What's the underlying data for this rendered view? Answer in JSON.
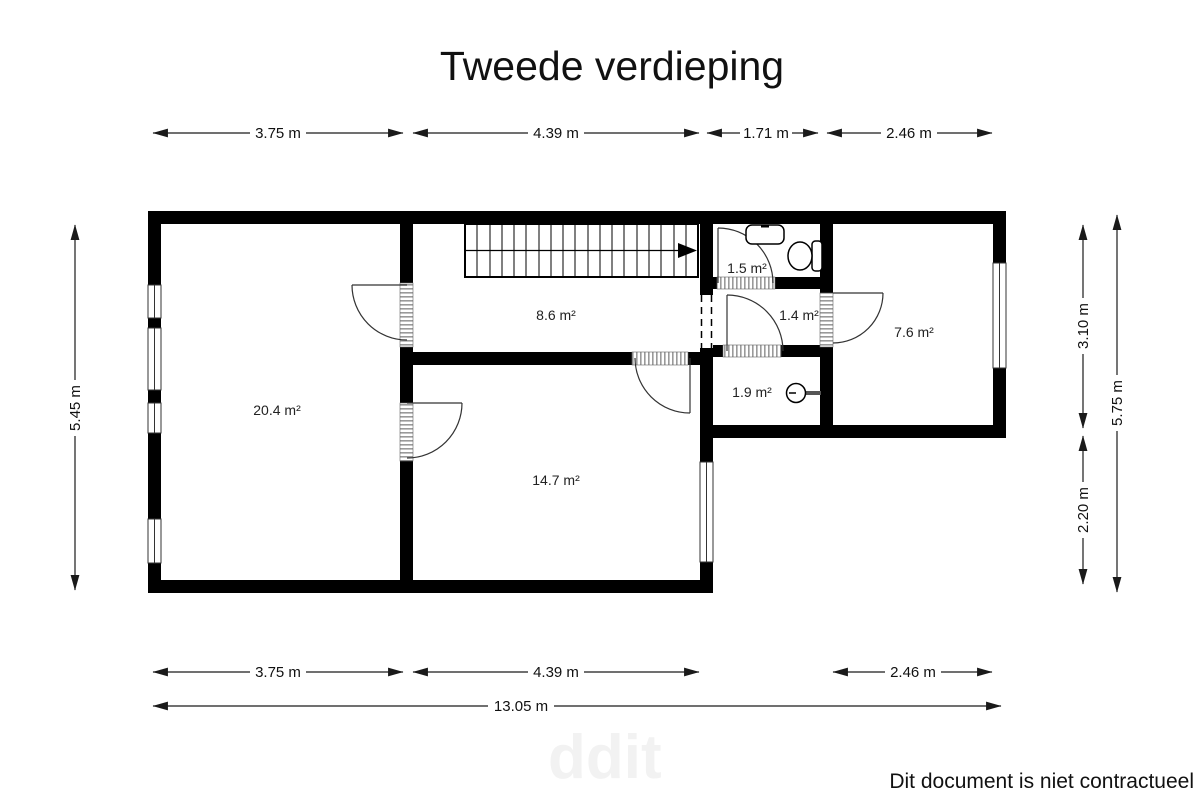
{
  "title": "Tweede verdieping",
  "floorplan": {
    "rooms": [
      {
        "name": "bedroom-large",
        "area_label": "20.4 m²"
      },
      {
        "name": "landing",
        "area_label": "8.6 m²"
      },
      {
        "name": "bedroom-middle",
        "area_label": "14.7 m²"
      },
      {
        "name": "toilet-room",
        "area_label": "1.5 m²"
      },
      {
        "name": "inner-hall",
        "area_label": "1.4 m²"
      },
      {
        "name": "shower-room",
        "area_label": "1.9 m²"
      },
      {
        "name": "bedroom-right",
        "area_label": "7.6 m²"
      }
    ],
    "dims": {
      "top": [
        "3.75 m",
        "4.39 m",
        "1.71 m",
        "2.46 m"
      ],
      "bottom": [
        "3.75 m",
        "4.39 m",
        "2.46 m"
      ],
      "total_width": "13.05 m",
      "left": "5.45 m",
      "right": [
        "3.10 m",
        "2.20 m"
      ],
      "right_total": "5.75 m"
    }
  },
  "footer": {
    "disclaimer": "Dit document is niet contractueel"
  },
  "watermark": "ddit",
  "colors": {
    "wall": "#000000",
    "background": "#ffffff",
    "dim_line": "#1a1a1a"
  }
}
